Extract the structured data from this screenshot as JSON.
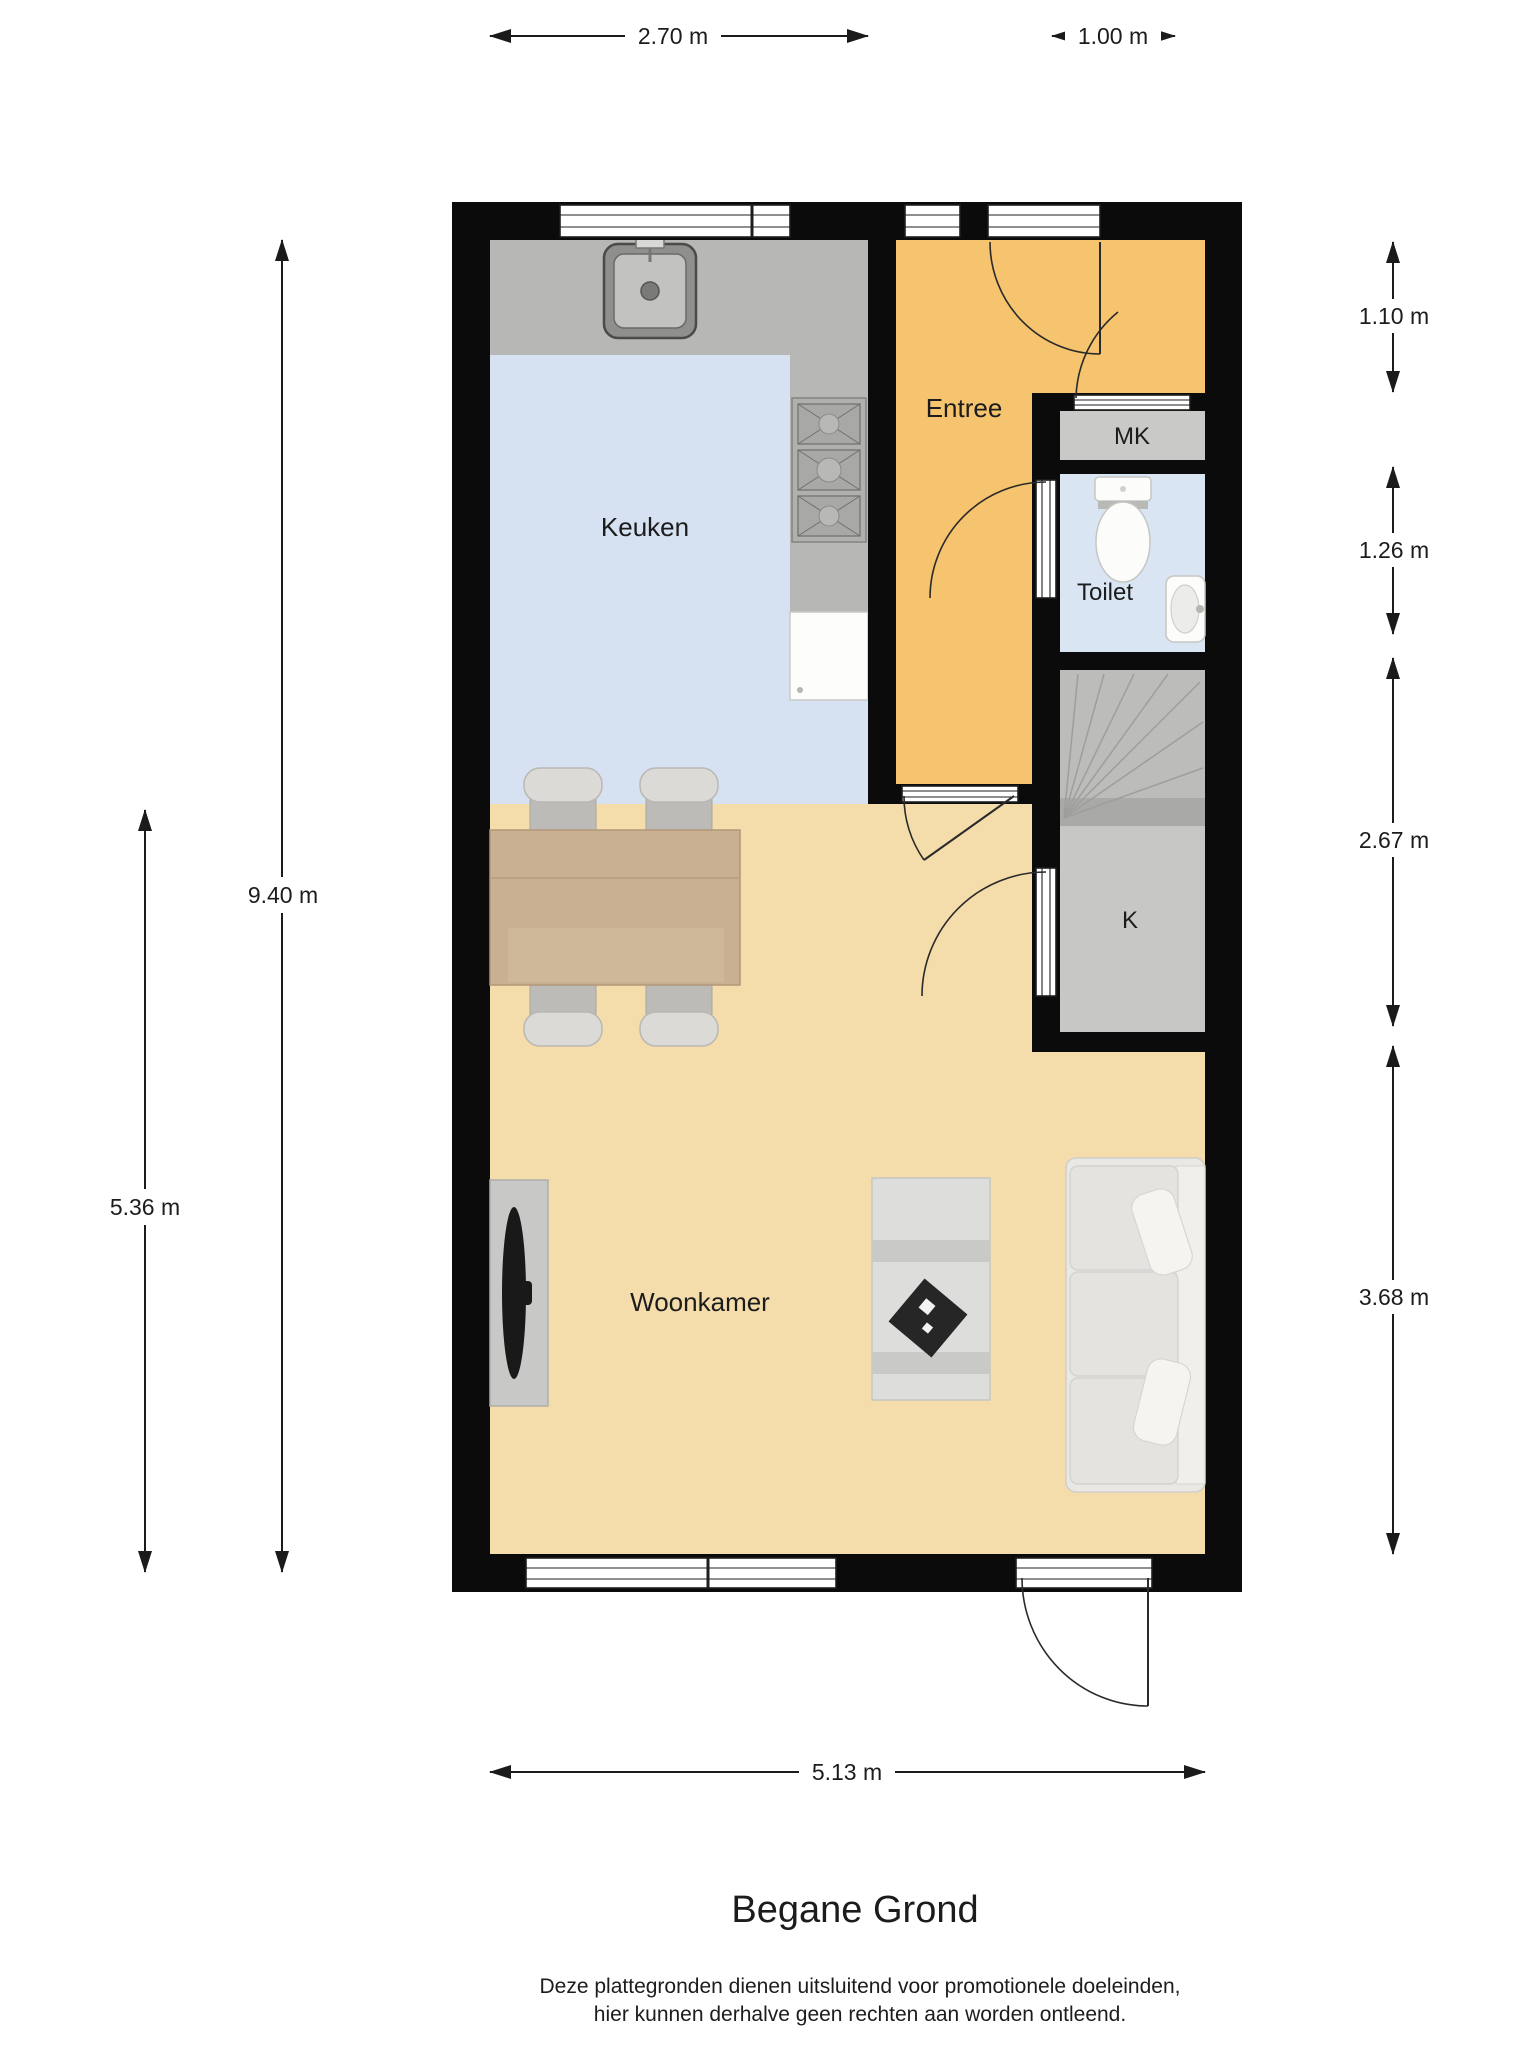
{
  "title": "Begane Grond",
  "disclaimer": {
    "line1": "Deze plattegronden dienen uitsluitend voor promotionele doeleinden,",
    "line2": "hier kunnen derhalve geen rechten aan worden ontleend."
  },
  "rooms": {
    "keuken": "Keuken",
    "entree": "Entree",
    "mk": "MK",
    "toilet": "Toilet",
    "kast": "K",
    "woonkamer": "Woonkamer"
  },
  "dims": {
    "top": [
      {
        "label": "2.70 m",
        "meters": 2.7
      },
      {
        "label": "1.00 m",
        "meters": 1.0
      }
    ],
    "right": [
      {
        "label": "1.10 m",
        "meters": 1.1
      },
      {
        "label": "1.26 m",
        "meters": 1.26
      },
      {
        "label": "2.67 m",
        "meters": 2.67
      },
      {
        "label": "3.68 m",
        "meters": 3.68
      }
    ],
    "left": [
      {
        "label": "9.40 m",
        "meters": 9.4
      },
      {
        "label": "5.36 m",
        "meters": 5.36
      }
    ],
    "bottom": [
      {
        "label": "5.13 m",
        "meters": 5.13
      }
    ]
  },
  "colors": {
    "wall": "#0b0b0b",
    "ink": "#1c1c1c",
    "kitchen": "#d6e2f1",
    "entree": "#f6c36e",
    "woonkamer": "#f4dcab",
    "toilet": "#d9e5f3",
    "mk": "#c9c9c7",
    "stairs": "#bcbcba",
    "stairsband": "#a9a9a7",
    "closet": "#c7c7c5",
    "counter": "#b7b7b5",
    "wood": "#c9b093"
  }
}
